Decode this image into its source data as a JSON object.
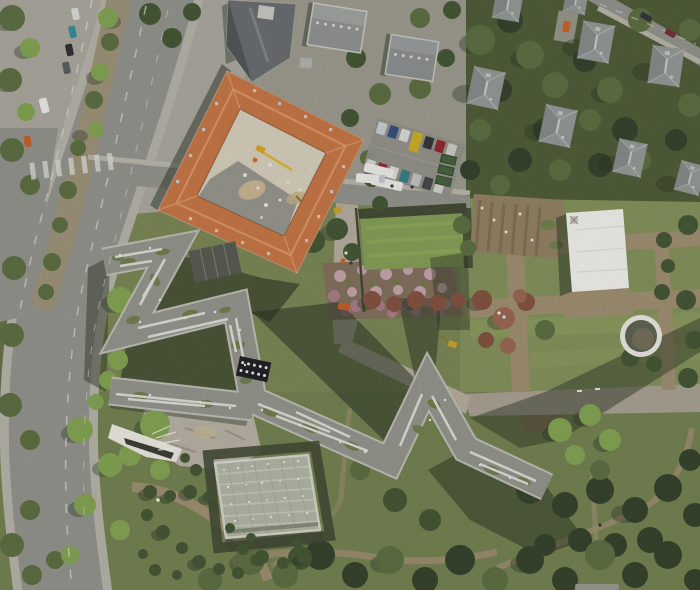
{
  "scene": {
    "kind": "aerial-orthophoto",
    "subject": "zigzag museum building beside orange-roofed baroque courtyard building, gardens, tree-lined curved boulevard, villas and park"
  },
  "palette": {
    "base_lawn": "#75824e",
    "park_lawn": "#6d7c49",
    "garden_lawn": "#7e8d54",
    "urban_ground": "#a7a49a",
    "wood_dark": "#47552f",
    "strip_wood": "#5c6b40",
    "road": "#8f8f89",
    "road_dirt": "#a59d8d",
    "sidewalk": "#b3b0a5",
    "median": "#998e74",
    "path_tan": "#9b8a6b",
    "marking": "#d9d9d3",
    "shadow": "#1f2919",
    "tree_deep": "#2c3a22",
    "tree_dark": "#3c4f2c",
    "tree_mid": "#55683a",
    "tree_bright": "#7da04b",
    "tree_red": "#7e4a38",
    "tree_red_light": "#95604a",
    "hedge": "#3a432c",
    "sunken_lawn": "#7f9a50",
    "mow_stripe": "#8fae58",
    "allotment": "#8d7c5c",
    "rose_base": "#7d6a56",
    "rose_light": "#c2a0a8",
    "rose_dark": "#a57883",
    "baroque_roof": "#c4703d",
    "baroque_ridge": "#db9563",
    "dormer": "#cac6be",
    "courtyard": "#d6cdb9",
    "courtyard_dark": "#8b8b83",
    "sand": "#cdb68d",
    "museum_parapet": "#bcbcb4",
    "museum_roof": "#8f9088",
    "skylight": "#dcdcd6",
    "moss": "#6b7845",
    "glass_court": "#51544b",
    "tent": "#f1f0ea",
    "exile_deck": "#aeb3a1",
    "exile_grid": "#c6cbbc",
    "pond_ring": "#e9e7df",
    "pond_water": "#565c49",
    "villa_roof": "#8f9492",
    "block_roof": "#8b8f8d",
    "plaza": "#b5aea0",
    "wedge": "#eae8e0",
    "crane_yellow": "#d8b430",
    "machine_yellow": "#c89e26"
  },
  "vehicles": {
    "parked_west": [
      "#d9d9d5",
      "#2e8a94",
      "#26262a",
      "#54565a"
    ],
    "van": "#e9e9e5",
    "orange_car": "#c05a20",
    "lot_row1": [
      "#c7ccd2",
      "#2c4878",
      "#d8d8d6",
      "#caa91e",
      "#2e2e32",
      "#8d1f24",
      "#c9c9c5"
    ],
    "lot_row2": [
      "#d2d2d0",
      "#8e2026",
      "#dadad8",
      "#2d7a80",
      "#bfc0c2",
      "#3c3e44",
      "#d0cfc9"
    ],
    "white_bus": "#ebebe7",
    "dumpster": "#3e5a35",
    "ne_road": [
      "#2a2e34",
      "#6b2a2e"
    ],
    "driveway_car": "#c75b1f",
    "street_truck": "#ecece8",
    "walk_van": "#c0561d"
  },
  "counts": {
    "villas_visible": 8,
    "round_bushes": 22,
    "median_trees": 10
  }
}
